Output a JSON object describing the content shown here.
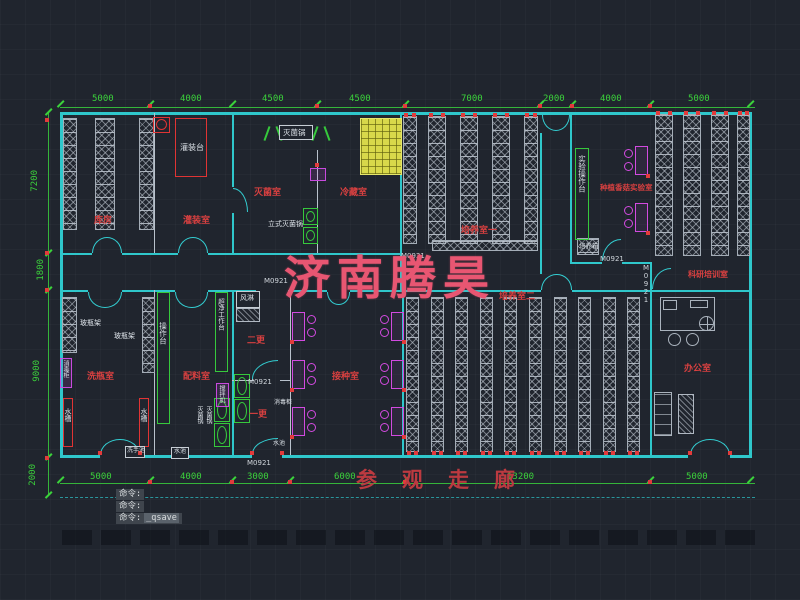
{
  "app": {
    "type": "cad-floorplan",
    "background": "#20252e",
    "colors": {
      "wall": "#2fc7cb",
      "dimension": "#3bd23b",
      "room_label": "#d84040",
      "equipment": "#dbe1e7",
      "magenta": "#d24ae0",
      "watermark": "#e85672"
    }
  },
  "labels": {
    "watermark": {
      "t": "济南腾昊",
      "x": 284,
      "y": 242
    },
    "corridor": {
      "t": "参观走廊",
      "x": 356,
      "y": 464
    },
    "rooms": [
      {
        "t": "库房",
        "x": 94,
        "y": 217
      },
      {
        "t": "灌装室",
        "x": 183,
        "y": 217
      },
      {
        "t": "灭菌室",
        "x": 254,
        "y": 189
      },
      {
        "t": "冷藏室",
        "x": 340,
        "y": 189
      },
      {
        "t": "培养室一",
        "x": 461,
        "y": 227
      },
      {
        "t": "种植香菇实验室",
        "x": 600,
        "y": 184,
        "fs": 7.5
      },
      {
        "t": "科研培训室",
        "x": 688,
        "y": 271,
        "fs": 8
      },
      {
        "t": "办公室",
        "x": 684,
        "y": 365
      },
      {
        "t": "培养室二",
        "x": 499,
        "y": 293
      },
      {
        "t": "接种室",
        "x": 332,
        "y": 373
      },
      {
        "t": "二更",
        "x": 247,
        "y": 337
      },
      {
        "t": "一更",
        "x": 249,
        "y": 411
      },
      {
        "t": "洗瓶室",
        "x": 87,
        "y": 373
      },
      {
        "t": "配料室",
        "x": 183,
        "y": 373
      }
    ],
    "equipment": [
      {
        "t": "灌装台",
        "x": 180,
        "y": 144
      },
      {
        "t": "灭菌锅",
        "x": 283,
        "y": 129,
        "fs": 7.5
      },
      {
        "t": "立式灭菌锅",
        "x": 268,
        "y": 221,
        "fs": 7
      },
      {
        "t": "风淋",
        "x": 240,
        "y": 295,
        "fs": 7
      },
      {
        "t": "玻瓶架",
        "x": 80,
        "y": 320,
        "fs": 7
      },
      {
        "t": "玻瓶架",
        "x": 114,
        "y": 333,
        "fs": 7
      },
      {
        "t": "水槽",
        "x": 64,
        "y": 408,
        "fs": 7,
        "v": true
      },
      {
        "t": "水槽",
        "x": 140,
        "y": 408,
        "fs": 7,
        "v": true
      },
      {
        "t": "操作台",
        "x": 159,
        "y": 322,
        "fs": 7.5,
        "v": true
      },
      {
        "t": "超净工作台",
        "x": 217,
        "y": 298,
        "fs": 6.5,
        "v": true
      },
      {
        "t": "搅拌机",
        "x": 218,
        "y": 385,
        "fs": 6,
        "v": true
      },
      {
        "t": "消毒柜",
        "x": 62,
        "y": 360,
        "fs": 6,
        "v": true
      },
      {
        "t": "灭菌锅",
        "x": 196,
        "y": 406,
        "fs": 6,
        "v": true
      },
      {
        "t": "灭菌锅",
        "x": 205,
        "y": 406,
        "fs": 6,
        "v": true
      },
      {
        "t": "洗手池",
        "x": 127,
        "y": 448,
        "fs": 6
      },
      {
        "t": "水池",
        "x": 174,
        "y": 449,
        "fs": 6
      },
      {
        "t": "实验操作台",
        "x": 578,
        "y": 155,
        "fs": 7.5,
        "v": true
      },
      {
        "t": "培养箱",
        "x": 579,
        "y": 243,
        "fs": 6.5
      },
      {
        "t": "消毒柜",
        "x": 274,
        "y": 400,
        "fs": 6
      },
      {
        "t": "水池",
        "x": 273,
        "y": 441,
        "fs": 6
      }
    ],
    "door_marks": [
      {
        "t": "M0921",
        "x": 401,
        "y": 253
      },
      {
        "t": "M0921",
        "x": 264,
        "y": 278
      },
      {
        "t": "M0921",
        "x": 248,
        "y": 379
      },
      {
        "t": "M0921",
        "x": 247,
        "y": 460
      },
      {
        "t": "M0921",
        "x": 600,
        "y": 256
      },
      {
        "t": "M0921",
        "x": 642,
        "y": 264,
        "v": true
      }
    ]
  },
  "dims": {
    "top": [
      {
        "t": "5000",
        "x": 92,
        "y": 95
      },
      {
        "t": "4000",
        "x": 180,
        "y": 95
      },
      {
        "t": "4500",
        "x": 262,
        "y": 95
      },
      {
        "t": "4500",
        "x": 349,
        "y": 95
      },
      {
        "t": "7000",
        "x": 461,
        "y": 95
      },
      {
        "t": "2000",
        "x": 543,
        "y": 95
      },
      {
        "t": "4000",
        "x": 600,
        "y": 95
      },
      {
        "t": "5000",
        "x": 688,
        "y": 95
      }
    ],
    "left": [
      {
        "t": "7200",
        "x": 31,
        "y": 170
      },
      {
        "t": "1800",
        "x": 37,
        "y": 259
      },
      {
        "t": "9000",
        "x": 33,
        "y": 360
      },
      {
        "t": "2000",
        "x": 29,
        "y": 464
      }
    ],
    "bottom": [
      {
        "t": "5000",
        "x": 90,
        "y": 473
      },
      {
        "t": "4000",
        "x": 180,
        "y": 473
      },
      {
        "t": "3000",
        "x": 247,
        "y": 473
      },
      {
        "t": "6000",
        "x": 334,
        "y": 473
      },
      {
        "t": "13200",
        "x": 507,
        "y": 473
      },
      {
        "t": "5000",
        "x": 686,
        "y": 473
      }
    ]
  },
  "command": {
    "line1": "命令:",
    "line2": "命令:",
    "line3_prefix": "命令:",
    "line3_cmd": "_qsave"
  }
}
